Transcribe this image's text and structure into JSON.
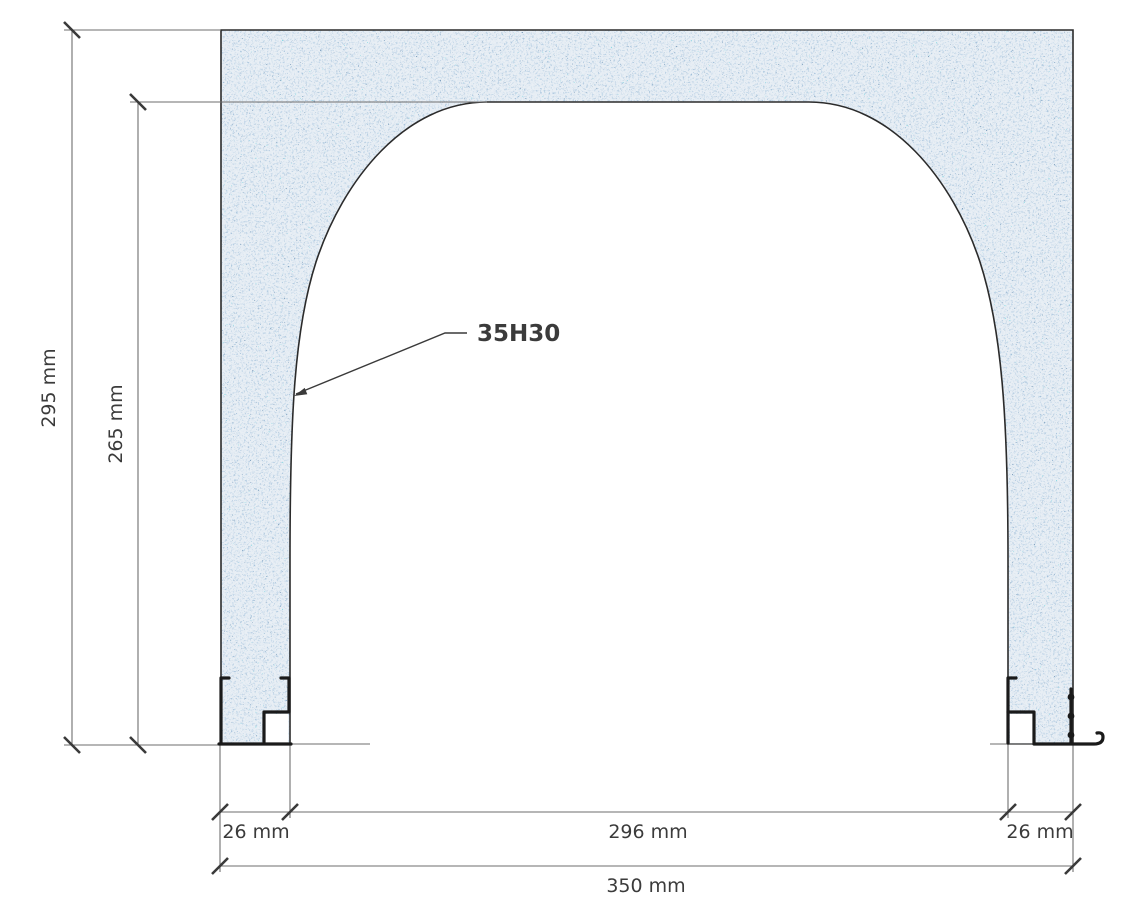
{
  "drawing": {
    "part_label": "35H30",
    "dimensions": {
      "overall_height": "295 mm",
      "opening_height": "265 mm",
      "left_jamb_width": "26 mm",
      "opening_width": "296 mm",
      "right_jamb_width": "26 mm",
      "overall_width": "350 mm"
    },
    "colors": {
      "outline": "#2b2b2b",
      "dimension_line": "#6e6e6e",
      "tick": "#3a3a3a",
      "text": "#3b3b3b",
      "profile": "#1a1a1a",
      "concrete_base": "#e9eff5",
      "speckle_light": "#c3d4e5",
      "speckle_mid": "#8fb0cf",
      "speckle_deep": "#5d87b2",
      "speckle_dark": "#33567e",
      "speckle_teal": "#35b3c2"
    }
  }
}
